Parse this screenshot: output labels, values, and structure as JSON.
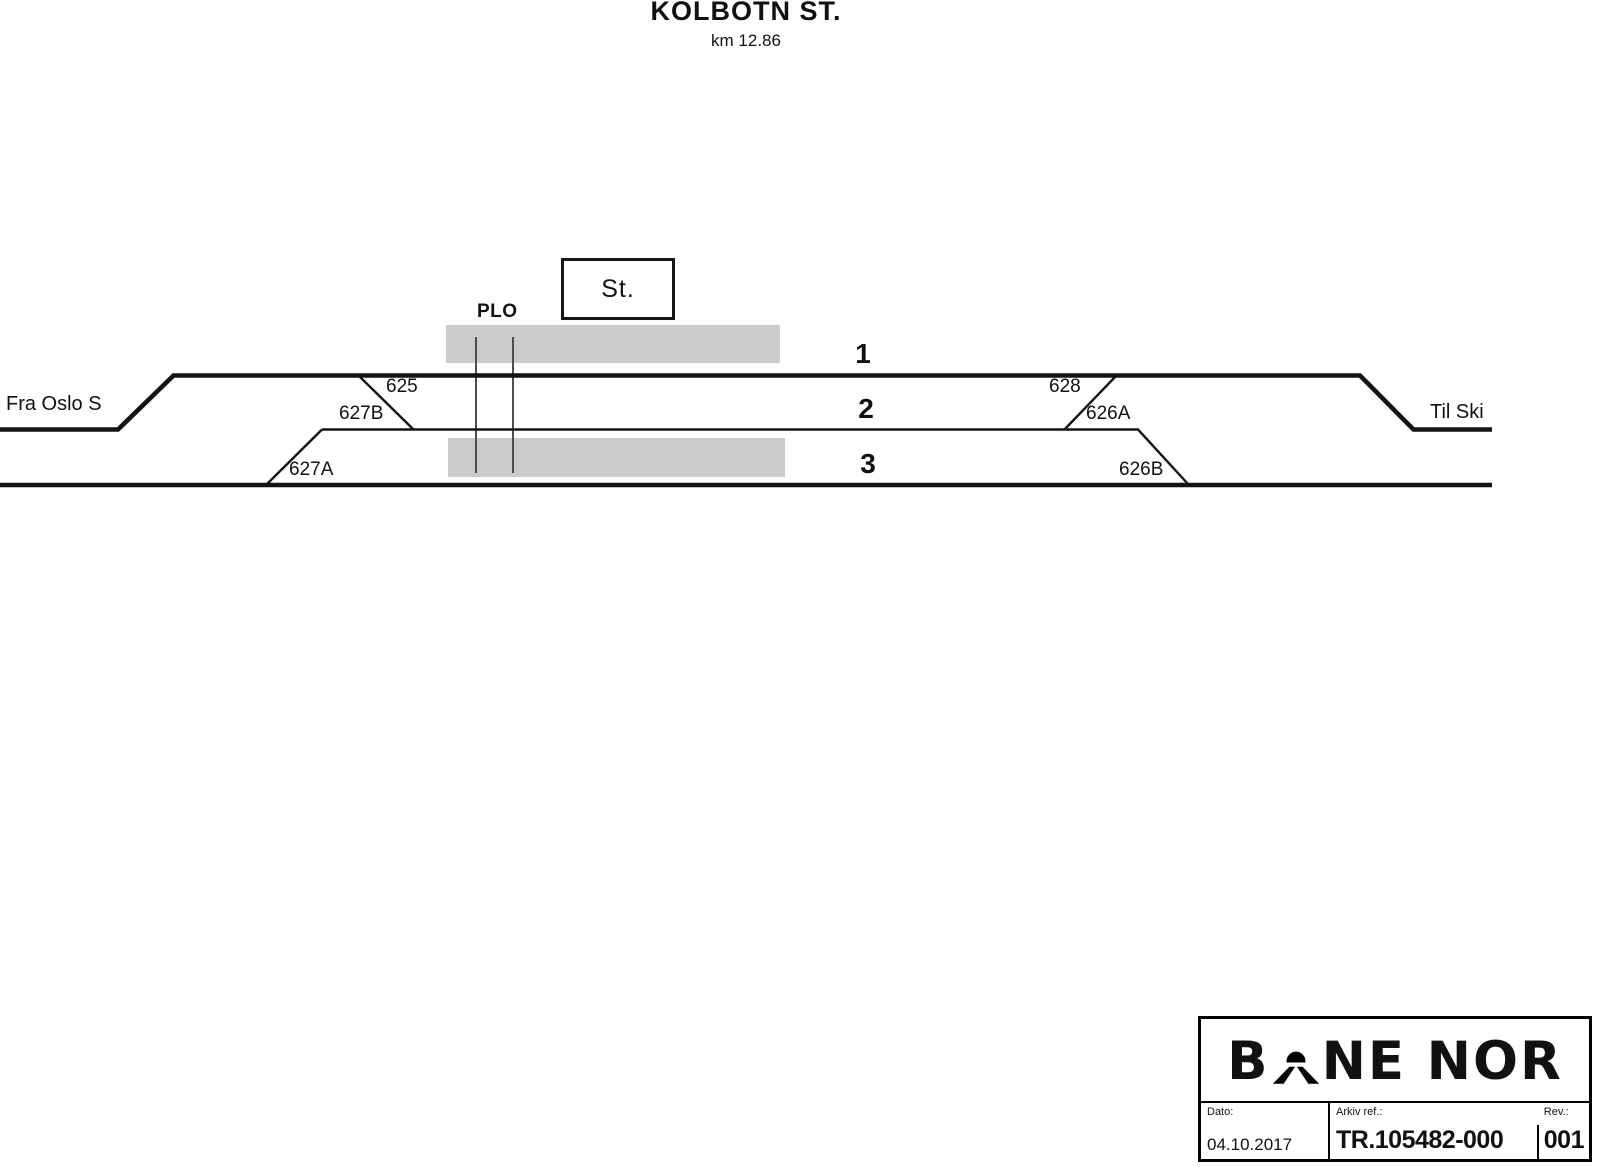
{
  "page": {
    "title": "KOLBOTN ST.",
    "subtitle": "km 12.86"
  },
  "diagram": {
    "from_label": "Fra Oslo S",
    "to_label": "Til Ski",
    "station_building_label": "St.",
    "level_crossing_label": "PLO",
    "track_numbers": [
      "1",
      "2",
      "3"
    ],
    "switches": {
      "625": "625",
      "627B": "627B",
      "627A": "627A",
      "628": "628",
      "626A": "626A",
      "626B": "626B"
    },
    "colors": {
      "line": "#141414",
      "platform": "#cbcbcb",
      "crossing": "#4d4d4d"
    }
  },
  "title_block": {
    "logo_left": "B",
    "logo_right": "NE NOR",
    "dato_label": "Dato:",
    "dato_value": "04.10.2017",
    "arkiv_label": "Arkiv ref.:",
    "arkiv_value": "TR.105482-000",
    "rev_label": "Rev.:",
    "rev_value": "001"
  }
}
